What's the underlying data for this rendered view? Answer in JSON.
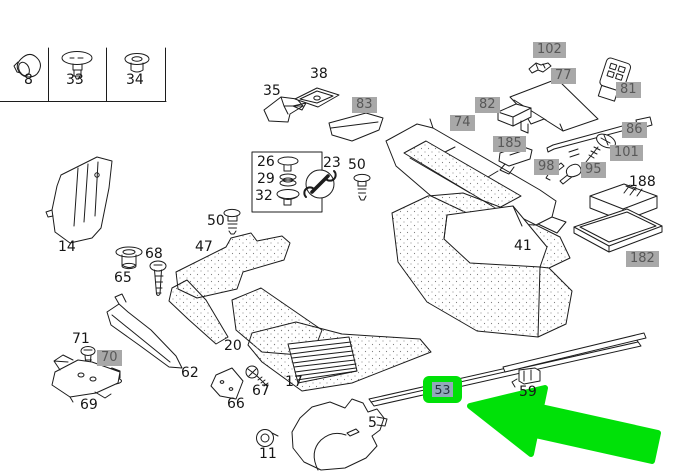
{
  "diagram": {
    "type": "exploded-parts-diagram",
    "selected_part": "53",
    "colors": {
      "highlight_gray": "#a8a8a8",
      "selection_green": "#00e108",
      "selection_inner": "#92a9b9",
      "line": "#1c1c1c",
      "carpet_dot": "#808080"
    },
    "labels": {
      "p8": {
        "text": "8",
        "style": "plain"
      },
      "p33": {
        "text": "33",
        "style": "plain"
      },
      "p34": {
        "text": "34",
        "style": "plain"
      },
      "p35": {
        "text": "35",
        "style": "plain"
      },
      "p38": {
        "text": "38",
        "style": "plain"
      },
      "p83": {
        "text": "83",
        "style": "gray"
      },
      "p74": {
        "text": "74",
        "style": "gray"
      },
      "p102": {
        "text": "102",
        "style": "gray"
      },
      "p77": {
        "text": "77",
        "style": "gray"
      },
      "p81": {
        "text": "81",
        "style": "gray"
      },
      "p82": {
        "text": "82",
        "style": "gray"
      },
      "p86": {
        "text": "86",
        "style": "gray"
      },
      "p185": {
        "text": "185",
        "style": "gray"
      },
      "p98": {
        "text": "98",
        "style": "gray"
      },
      "p95": {
        "text": "95",
        "style": "gray"
      },
      "p101": {
        "text": "101",
        "style": "gray"
      },
      "p188": {
        "text": "188",
        "style": "plain"
      },
      "p182": {
        "text": "182",
        "style": "gray"
      },
      "p14": {
        "text": "14",
        "style": "plain"
      },
      "p26": {
        "text": "26",
        "style": "plain"
      },
      "p29": {
        "text": "29",
        "style": "plain"
      },
      "p32": {
        "text": "32",
        "style": "plain"
      },
      "p23": {
        "text": "23",
        "style": "plain"
      },
      "p50a": {
        "text": "50",
        "style": "plain"
      },
      "p50b": {
        "text": "50",
        "style": "plain"
      },
      "p47": {
        "text": "47",
        "style": "plain"
      },
      "p65": {
        "text": "65",
        "style": "plain"
      },
      "p68": {
        "text": "68",
        "style": "plain"
      },
      "p41": {
        "text": "41",
        "style": "plain"
      },
      "p20": {
        "text": "20",
        "style": "plain"
      },
      "p71": {
        "text": "71",
        "style": "plain"
      },
      "p70": {
        "text": "70",
        "style": "gray"
      },
      "p69": {
        "text": "69",
        "style": "plain"
      },
      "p62": {
        "text": "62",
        "style": "plain"
      },
      "p66": {
        "text": "66",
        "style": "plain"
      },
      "p67": {
        "text": "67",
        "style": "plain"
      },
      "p17": {
        "text": "17",
        "style": "plain"
      },
      "p11": {
        "text": "11",
        "style": "plain"
      },
      "p5": {
        "text": "5",
        "style": "plain"
      },
      "p53": {
        "text": "53",
        "style": "selected"
      },
      "p59": {
        "text": "59",
        "style": "plain"
      }
    }
  }
}
